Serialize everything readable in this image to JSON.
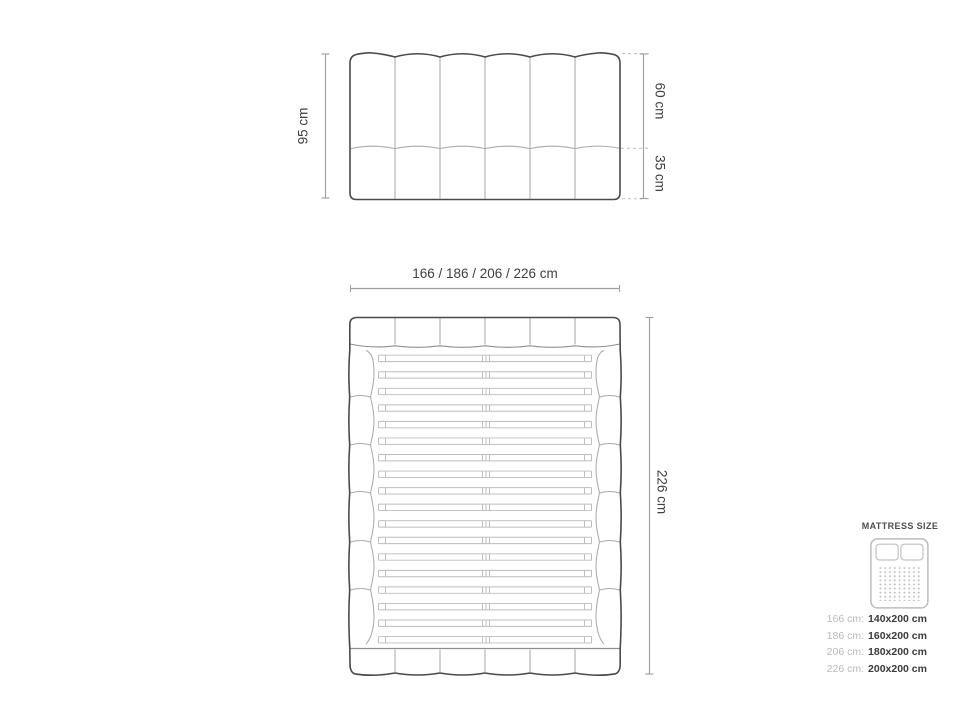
{
  "diagram": {
    "headboard_front": {
      "height_label": "95 cm",
      "upper_height_label": "60 cm",
      "lower_height_label": "35 cm",
      "channel_count": 6
    },
    "bed_plan": {
      "width_label": "166 / 186 / 206 / 226 cm",
      "length_label": "226 cm",
      "slat_count": 18,
      "rail_segment_count": 6,
      "channel_count": 6
    },
    "legend": {
      "title": "MATTRESS SIZE",
      "rows": [
        {
          "label": "166 cm:",
          "value": "140x200 cm"
        },
        {
          "label": "186 cm:",
          "value": "160x200 cm"
        },
        {
          "label": "206 cm:",
          "value": "180x200 cm"
        },
        {
          "label": "226 cm:",
          "value": "200x200 cm"
        }
      ]
    },
    "colors": {
      "background": "#ffffff",
      "outline_dark": "#4a4a4a",
      "line_light": "#aaaaaa",
      "dim_line": "#9f9f9f",
      "text_dark": "#3f3f3f",
      "legend_label": "#b9b9b9",
      "legend_value": "#3a3a3a"
    }
  }
}
